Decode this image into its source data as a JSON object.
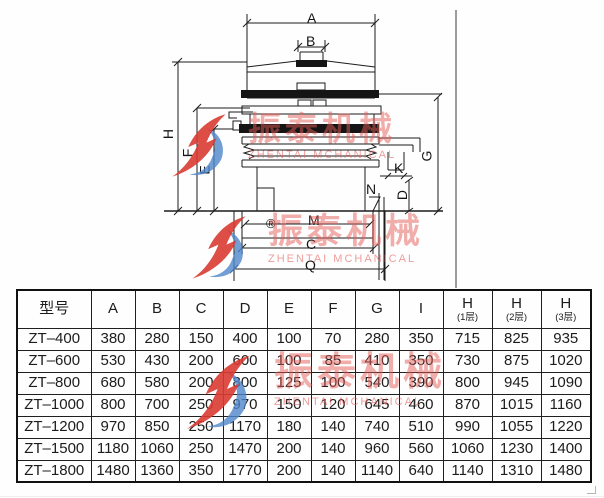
{
  "watermark": {
    "cn": "振泰机械",
    "en": "ZHENTAI MCHANICAL"
  },
  "diagram": {
    "labels": {
      "A": "A",
      "B": "B",
      "H": "H",
      "F": "F",
      "E": "E",
      "G": "G",
      "K": "K",
      "N": "N",
      "D": "D",
      "M": "M",
      "C": "C",
      "Q": "Q"
    },
    "registered_symbol": "®"
  },
  "table": {
    "model_header": "型号",
    "dim_headers": [
      "A",
      "B",
      "C",
      "D",
      "E",
      "F",
      "G",
      "I"
    ],
    "h_headers": [
      {
        "main": "H",
        "sub": "(1层)"
      },
      {
        "main": "H",
        "sub": "(2层)"
      },
      {
        "main": "H",
        "sub": "(3层)"
      }
    ],
    "rows": [
      [
        "ZT–400",
        "380",
        "280",
        "150",
        "400",
        "100",
        "70",
        "280",
        "350",
        "715",
        "825",
        "935"
      ],
      [
        "ZT–600",
        "530",
        "430",
        "200",
        "600",
        "100",
        "85",
        "410",
        "350",
        "730",
        "875",
        "1020"
      ],
      [
        "ZT–800",
        "680",
        "580",
        "200",
        "800",
        "125",
        "100",
        "540",
        "390",
        "800",
        "945",
        "1090"
      ],
      [
        "ZT–1000",
        "800",
        "700",
        "250",
        "970",
        "150",
        "120",
        "645",
        "460",
        "870",
        "1015",
        "1160"
      ],
      [
        "ZT–1200",
        "970",
        "850",
        "250",
        "1170",
        "180",
        "140",
        "740",
        "510",
        "990",
        "1055",
        "1220"
      ],
      [
        "ZT–1500",
        "1180",
        "1060",
        "250",
        "1470",
        "200",
        "140",
        "960",
        "560",
        "1060",
        "1230",
        "1400"
      ],
      [
        "ZT–1800",
        "1480",
        "1360",
        "350",
        "1770",
        "200",
        "140",
        "1140",
        "640",
        "1140",
        "1310",
        "1480"
      ]
    ]
  }
}
